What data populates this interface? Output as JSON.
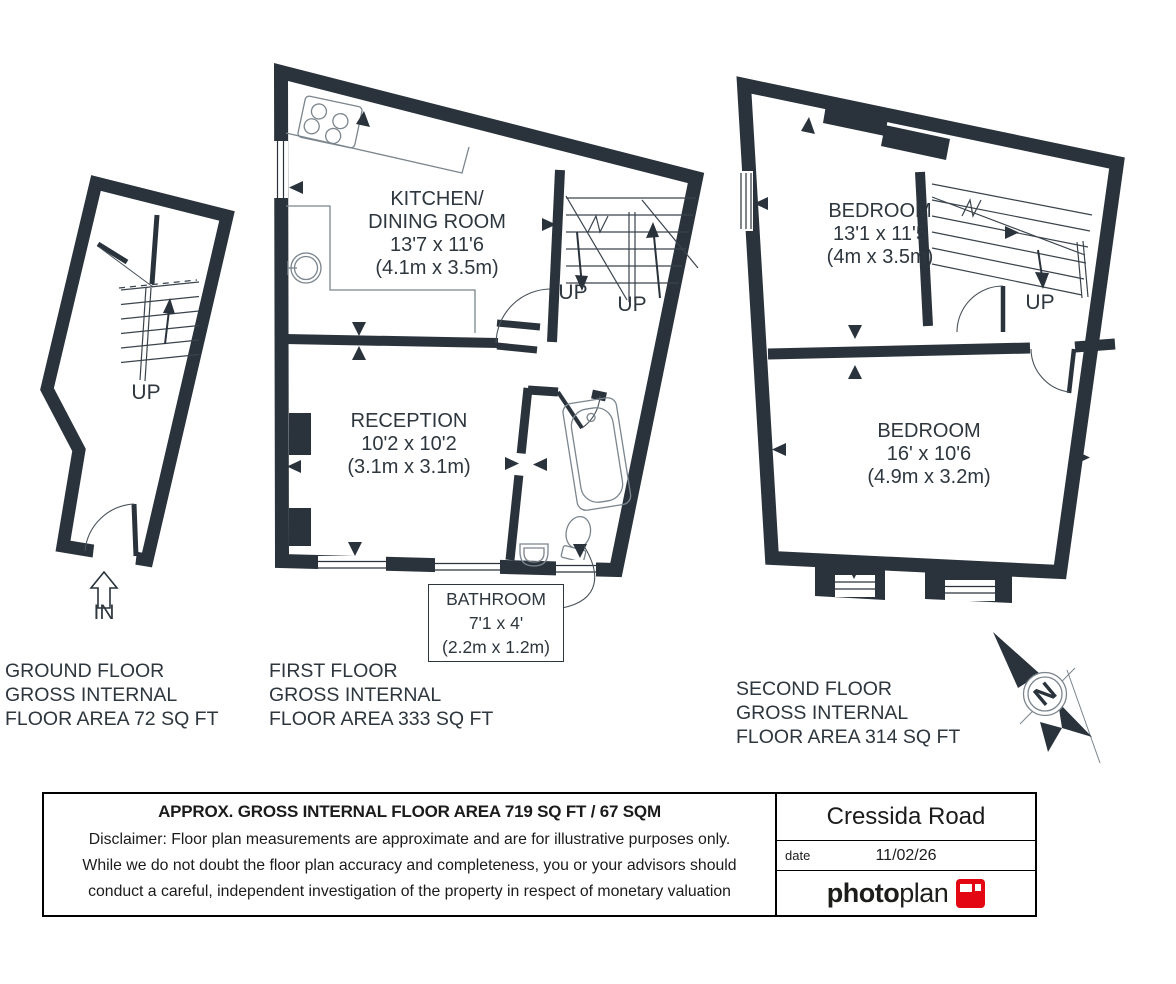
{
  "palette": {
    "wall_color": "#2a333c",
    "fixture_color": "#7b858d",
    "accent_red": "#e30613"
  },
  "plans": {
    "ground": {
      "up": "UP",
      "entrance": "IN",
      "caption": [
        "GROUND FLOOR",
        "GROSS INTERNAL",
        "FLOOR AREA 72 SQ FT"
      ]
    },
    "first": {
      "kitchen": {
        "line1": "KITCHEN/",
        "line2": "DINING ROOM",
        "dims_ft": "13'7 x 11'6",
        "dims_m": "(4.1m x 3.5m)"
      },
      "reception": {
        "line1": "RECEPTION",
        "dims_ft": "10'2 x 10'2",
        "dims_m": "(3.1m x 3.1m)"
      },
      "bathroom": {
        "line1": "BATHROOM",
        "dims_ft": "7'1 x 4'",
        "dims_m": "(2.2m x 1.2m)"
      },
      "up1": "UP",
      "up2": "UP",
      "caption": [
        "FIRST FLOOR",
        "GROSS INTERNAL",
        "FLOOR AREA 333 SQ FT"
      ]
    },
    "second": {
      "bedroom1": {
        "line1": "BEDROOM",
        "dims_ft": "13'1 x 11'5",
        "dims_m": "(4m x 3.5m)"
      },
      "bedroom2": {
        "line1": "BEDROOM",
        "dims_ft": "16' x 10'6",
        "dims_m": "(4.9m x 3.2m)"
      },
      "up": "UP",
      "caption": [
        "SECOND FLOOR",
        "GROSS INTERNAL",
        "FLOOR AREA 314 SQ FT"
      ]
    }
  },
  "compass": {
    "letter": "N"
  },
  "footer": {
    "area_heading": "APPROX. GROSS INTERNAL FLOOR AREA 719 SQ FT / 67 SQM",
    "disclaimer": [
      "Disclaimer: Floor plan measurements are approximate and are for illustrative purposes only.",
      "While we do not doubt the floor plan accuracy and completeness, you or your advisors should",
      "conduct a careful, independent investigation of the property in respect of monetary valuation"
    ],
    "address": "Cressida Road",
    "date_label": "date",
    "date_value": "11/02/26",
    "logo": {
      "part1": "photo",
      "part2": "plan"
    }
  }
}
